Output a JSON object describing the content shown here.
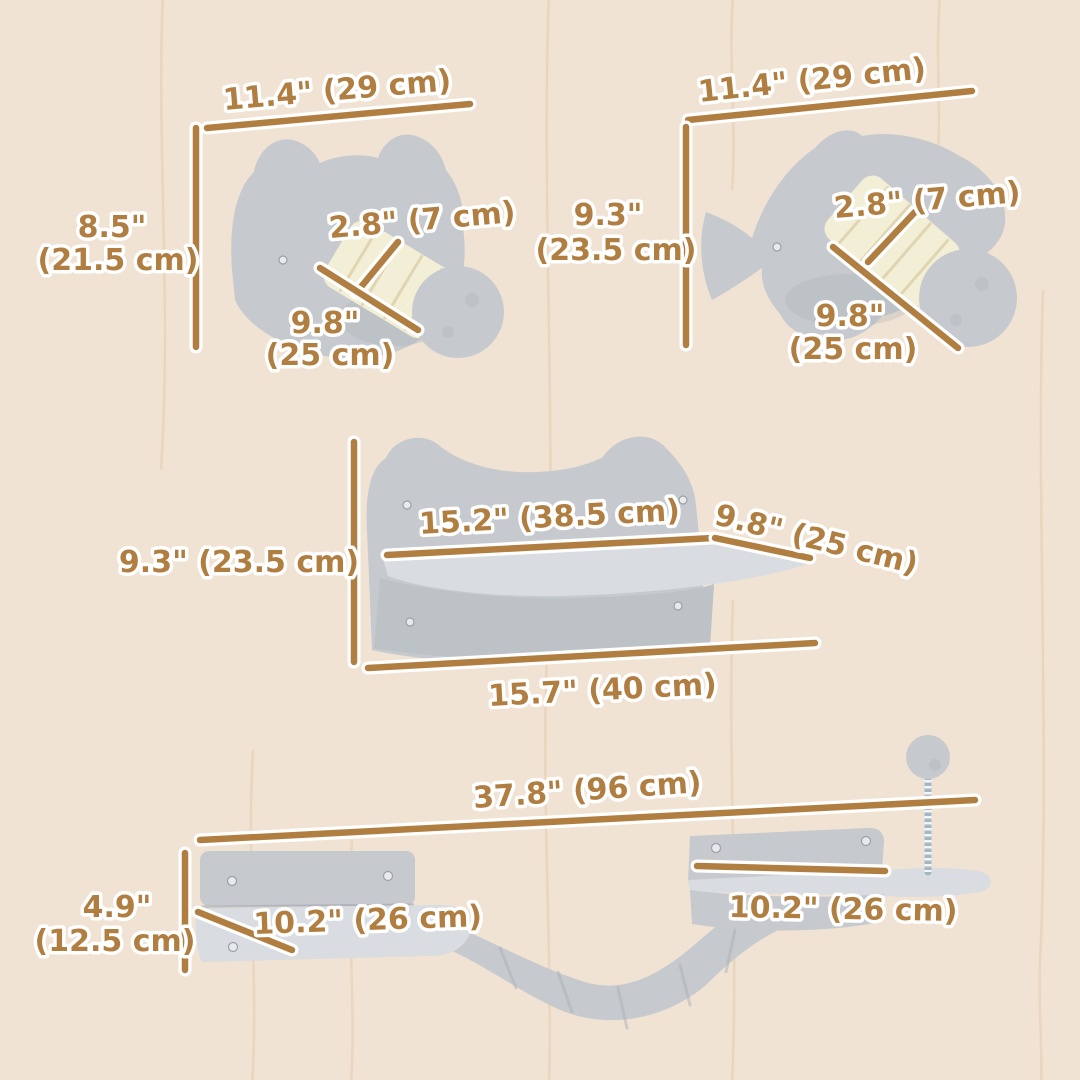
{
  "colors": {
    "background": "#f1e3d3",
    "wave": "#e9d2b8",
    "dimension": "#b07e41",
    "halo": "#ffffff",
    "plush": "#c6cace",
    "plush_light": "#d9dce0",
    "plush_dark": "#a9aeb5",
    "sisal": "#f3eed6",
    "sisal_stripe": "#ddd3ae",
    "spring": "#a3b8c4",
    "screw": "#e9eaec"
  },
  "figure": {
    "cat_head_shelf": {
      "width": "11.4\" (29 cm)",
      "height_in": "8.5\"",
      "height_cm": "(21.5 cm)",
      "post_diameter": "2.8\" (7 cm)",
      "post_length_in": "9.8\"",
      "post_length_cm": "(25 cm)"
    },
    "fish_shelf": {
      "width": "11.4\" (29 cm)",
      "height_in": "9.3\"",
      "height_cm": "(23.5 cm)",
      "post_diameter": "2.8\" (7 cm)",
      "post_length_in": "9.8\"",
      "post_length_cm": "(25 cm)"
    },
    "ear_shelf": {
      "top_width": "15.2\" (38.5 cm)",
      "depth": "9.8\" (25 cm)",
      "height": "9.3\" (23.5 cm)",
      "bottom_width": "15.7\" (40 cm)"
    },
    "bridge_set": {
      "total_width": "37.8\" (96 cm)",
      "height_in": "4.9\"",
      "height_cm": "(12.5 cm)",
      "left_shelf_width": "10.2\" (26 cm)",
      "right_shelf_width": "10.2\" (26 cm)"
    }
  }
}
